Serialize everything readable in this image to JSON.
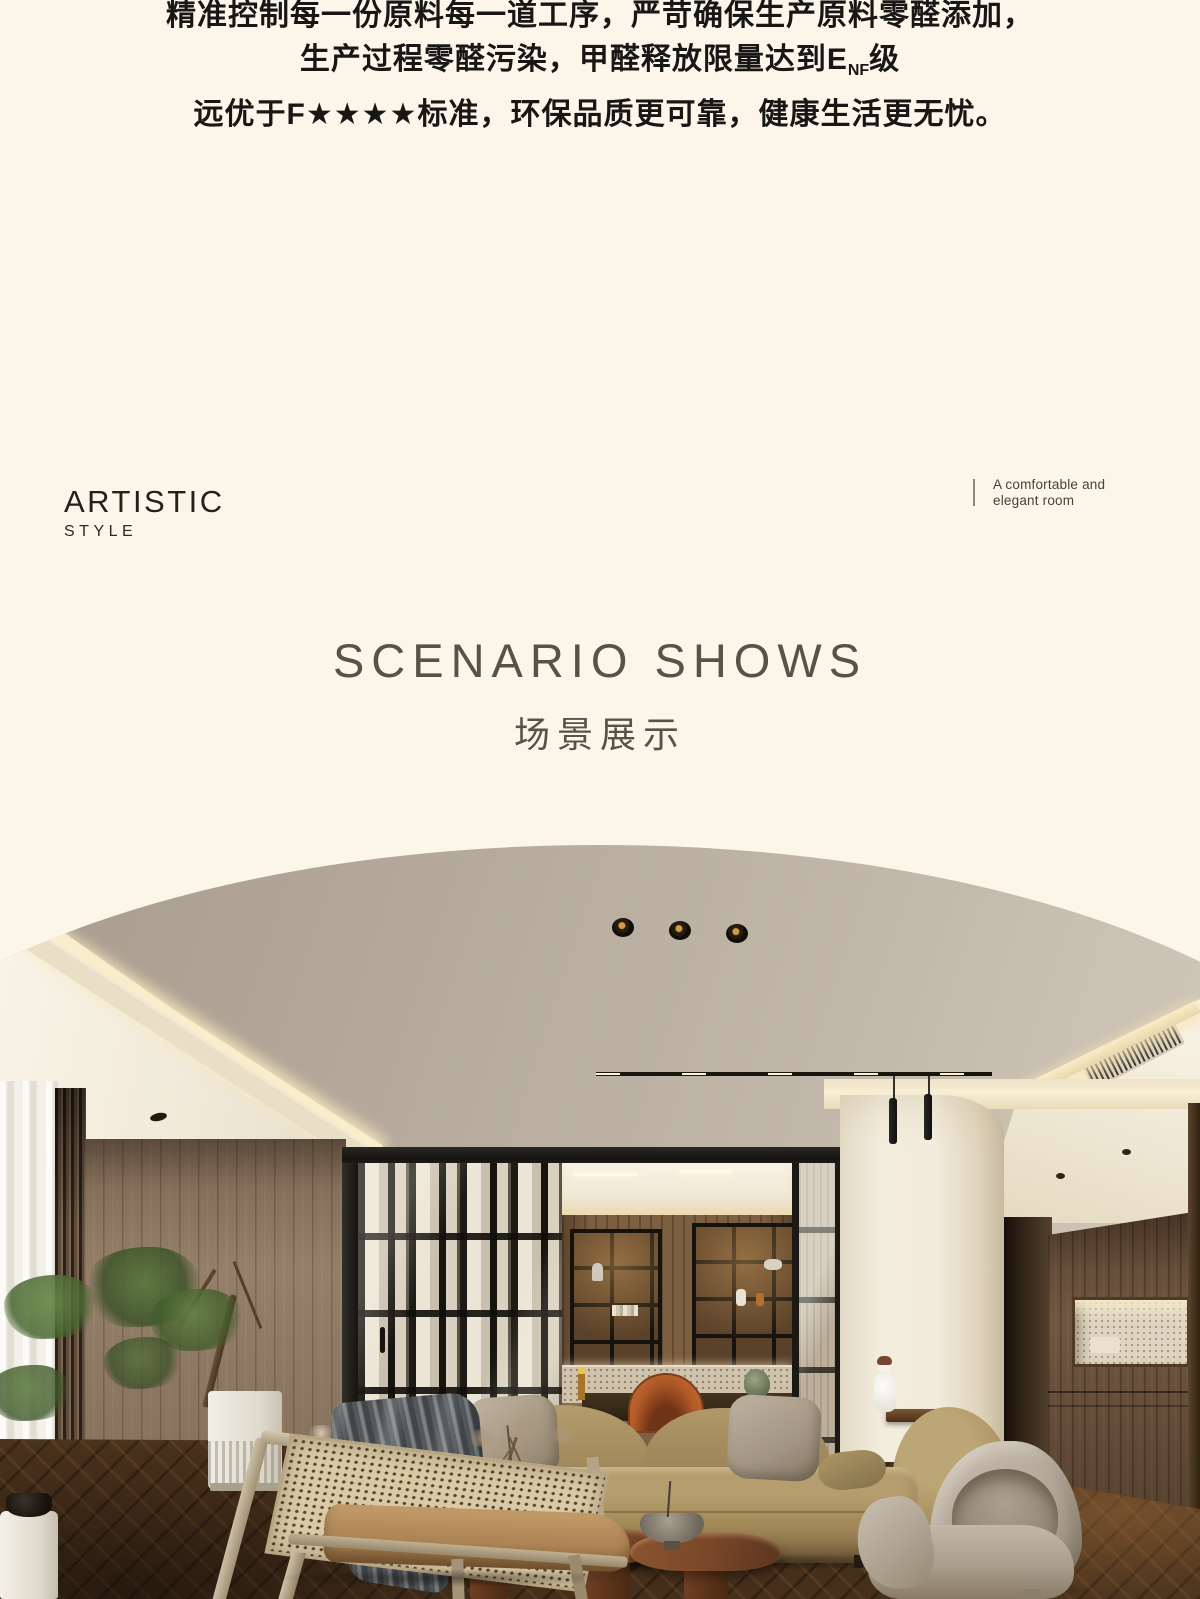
{
  "intro": {
    "line1": "精准控制每一份原料每一道工序，严苛确保生产原料零醛添加，",
    "line2_prefix": "生产过程零醛污染，甲醛释放限量达到E",
    "line2_sub": "NF",
    "line2_suffix": "级",
    "line3": "远优于F★★★★标准，环保品质更可靠，健康生活更无忧。"
  },
  "style_block": {
    "title": "ARTISTIC",
    "subtitle": "STYLE"
  },
  "room_note": {
    "text": "A comfortable and\nelegant room"
  },
  "section_header": {
    "title_en": "SCENARIO SHOWS",
    "title_zh": "场景展示"
  },
  "palette": {
    "background": "#fcf6ea",
    "text_dark": "#181715",
    "heading_gray": "#585349",
    "ceiling_taupe": "#b1a698",
    "ceiling_cream": "#f1ead9",
    "cove_glow": "#f9eecb",
    "wood_wall": "#8f7963",
    "door_frame": "#1c1914",
    "column_white": "#f3ecdc",
    "sofa_tan": "#a18856",
    "throw_gray": "#55595b",
    "floor_brown": "#452f1b",
    "foliage_green": "#5c783e",
    "table_walnut": "#7c4a2a",
    "armchair_beige": "#b1a595",
    "accent_orange": "#cf7138"
  }
}
